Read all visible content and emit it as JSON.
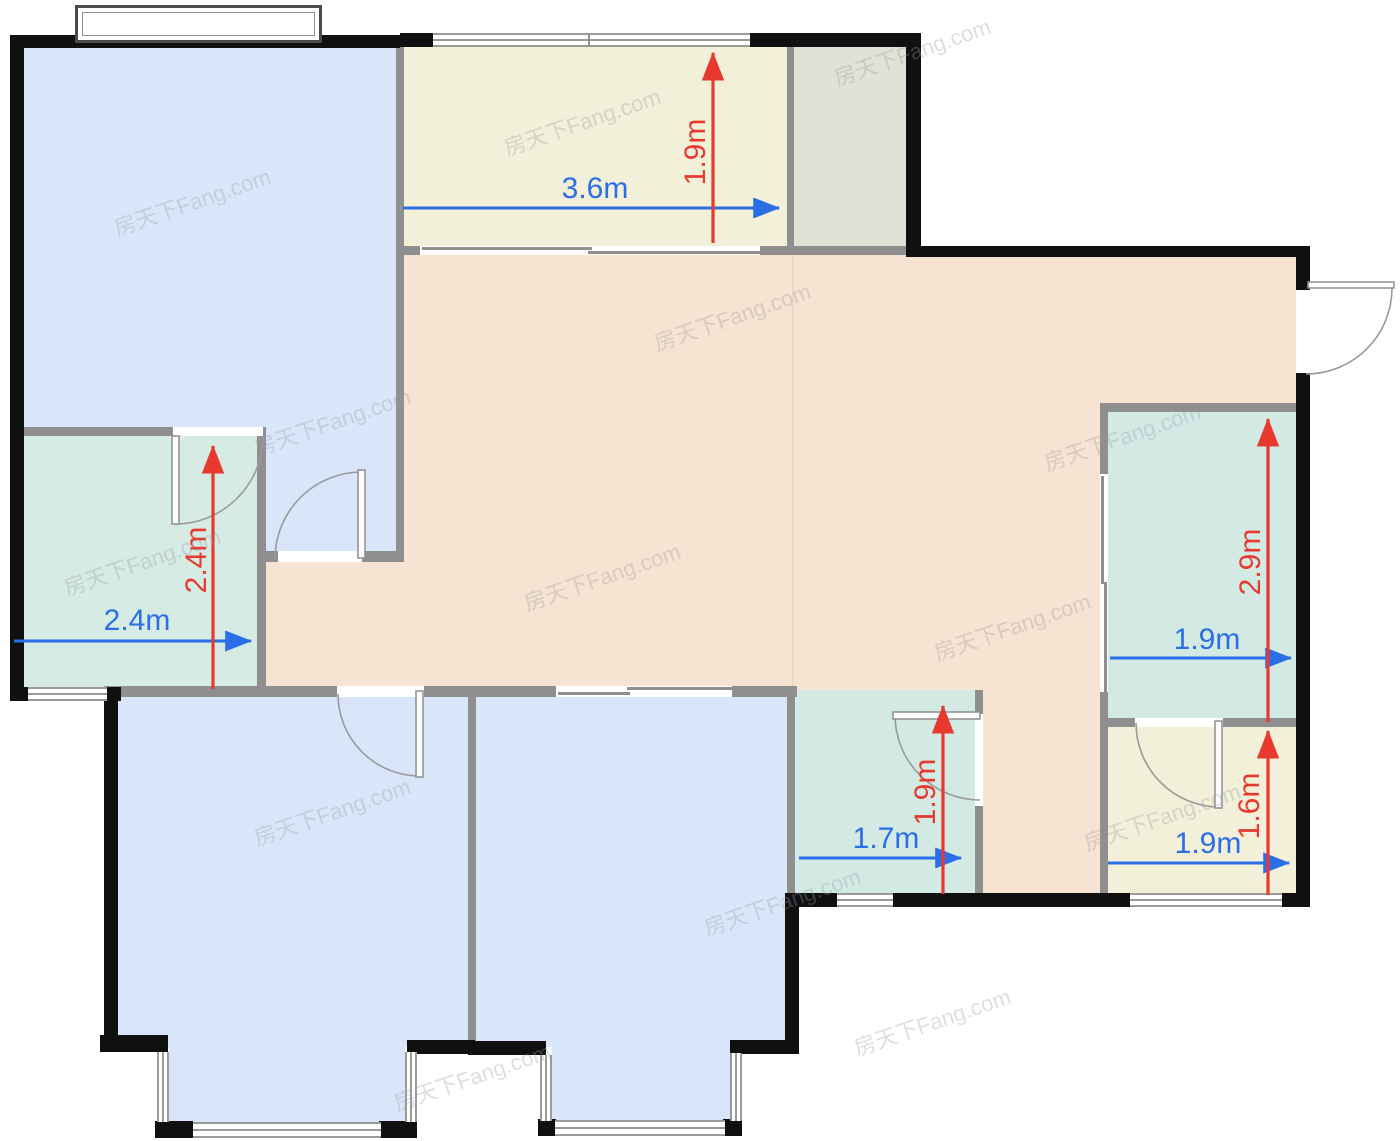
{
  "watermark": {
    "text": "房天下Fang.com"
  },
  "colors": {
    "dimension_blue": "#2a6ee8",
    "dimension_red": "#e8392f",
    "wall_black": "#101010",
    "wall_gray": "#8f8f8f",
    "room_blue": "#d9e6fa",
    "room_beige": "#f6e3d1",
    "room_yellow": "#f2f0d9",
    "room_gray": "#e1e1d6",
    "room_green": "#d6ebe3"
  },
  "rooms": [
    {
      "name": "bedroom-top-left",
      "color": "blue"
    },
    {
      "name": "balcony-top",
      "color": "yellow"
    },
    {
      "name": "utility-top-right",
      "color": "gray"
    },
    {
      "name": "living-dining",
      "color": "beige"
    },
    {
      "name": "bathroom-left",
      "color": "green"
    },
    {
      "name": "bathroom-right",
      "color": "green"
    },
    {
      "name": "bathroom-middle",
      "color": "green"
    },
    {
      "name": "room-bottom-right",
      "color": "yellow"
    },
    {
      "name": "bedroom-bottom-left",
      "color": "blue"
    },
    {
      "name": "bedroom-bottom-right",
      "color": "blue"
    }
  ],
  "dimensions": [
    {
      "room": "balcony-top",
      "value": "3.6m",
      "axis": "horizontal",
      "color": "blue"
    },
    {
      "room": "balcony-top",
      "value": "1.9m",
      "axis": "vertical",
      "color": "red"
    },
    {
      "room": "bathroom-left",
      "value": "2.4m",
      "axis": "horizontal",
      "color": "blue"
    },
    {
      "room": "bathroom-left",
      "value": "2.4m",
      "axis": "vertical",
      "color": "red"
    },
    {
      "room": "bathroom-right",
      "value": "1.9m",
      "axis": "horizontal",
      "color": "blue"
    },
    {
      "room": "bathroom-right",
      "value": "2.9m",
      "axis": "vertical",
      "color": "red"
    },
    {
      "room": "bathroom-middle",
      "value": "1.7m",
      "axis": "horizontal",
      "color": "blue"
    },
    {
      "room": "bathroom-middle",
      "value": "1.9m",
      "axis": "vertical",
      "color": "red"
    },
    {
      "room": "room-bottom-right",
      "value": "1.9m",
      "axis": "horizontal",
      "color": "blue"
    },
    {
      "room": "room-bottom-right",
      "value": "1.6m",
      "axis": "vertical",
      "color": "red"
    }
  ]
}
